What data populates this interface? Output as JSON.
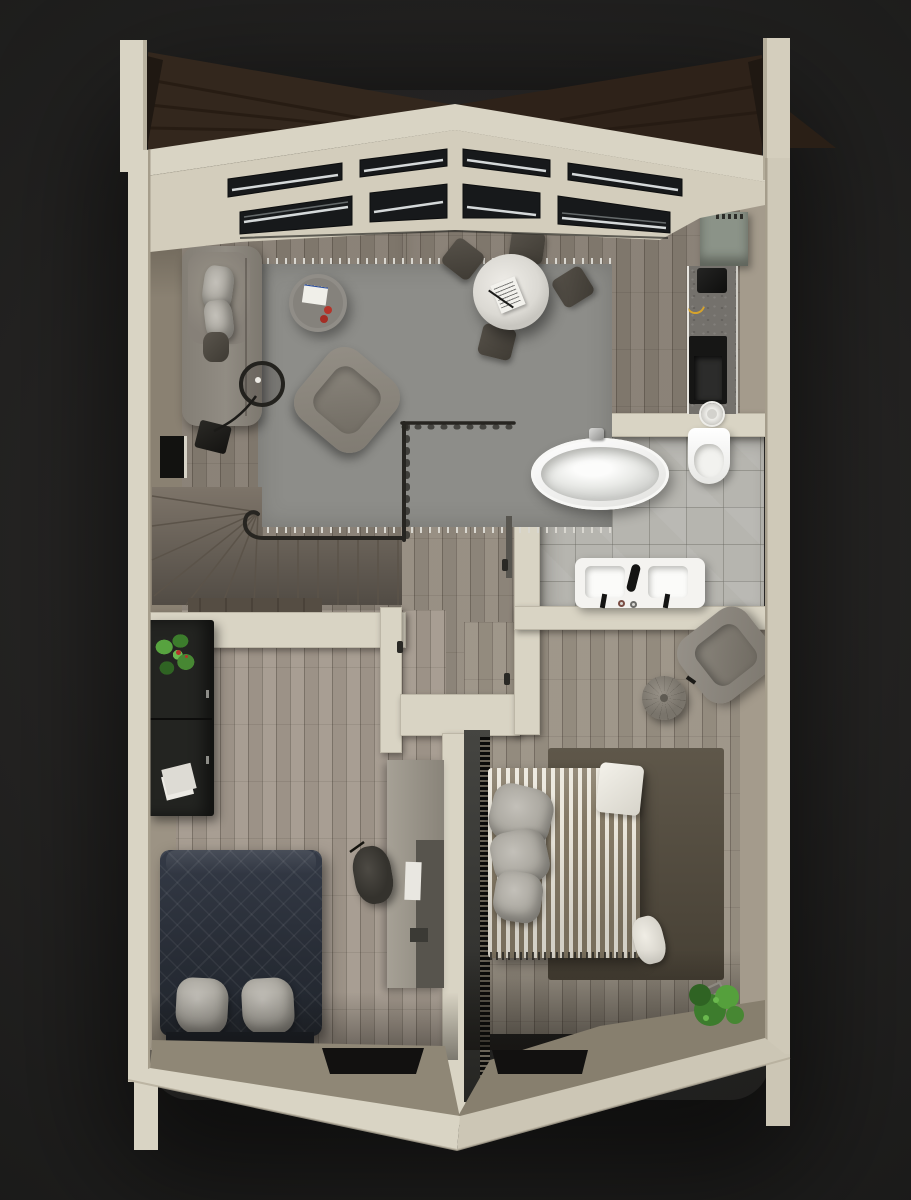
{
  "scene": {
    "type": "3d-floor-plan-top-view",
    "style": "photoreal architectural render, single storey, gabled shell",
    "background": "#242322"
  },
  "palette": {
    "background": "#242322",
    "wall": "#d9d4c4",
    "wall_shade": "#ccc6b5",
    "wall_inner_left": "#8a8172",
    "wall_inner_light": "#9c9384",
    "wall_inner_right": "#a49b8c",
    "tan_face": "#8f8776",
    "roof_wood": "#33271d",
    "skylight_glass": "#17191b",
    "skylight_glint": "#e6eaeb",
    "floor_living": "#867d72",
    "floor_hall": "#948b7f",
    "floor_bedroom_small": "#a49a8e",
    "floor_bedroom_master": "#9b9285",
    "floor_stairs": "#7d7469",
    "tile_bathroom": "#b6b5af",
    "rug_gray": "#8d8d89",
    "rug_olive": "#564e40",
    "sofa": "#868078",
    "armchair": "#8c877e",
    "chair_dark": "#4b463f",
    "dining_table": "#e7e5e0",
    "coffee_table": "#85827c",
    "counter_concrete": "#74716c",
    "cabinet_sage": "#8b9388",
    "appliance_black": "#161615",
    "porcelain": "#f4f3f0",
    "bed_dark_duvet": "#2b303a",
    "bed_base_dark": "#1b1f26",
    "pillow_light": "#b3b0a9",
    "stripe_light": "#ebe7dc",
    "stripe_dark": "#857a66",
    "radiator_black": "#0b0b0a",
    "sideboard_black": "#232421",
    "desk": "#9c968a",
    "wardrobe": "#57544d",
    "plant_green": "#4a8f38",
    "accent_red": "#b5342a",
    "banana_yellow": "#d6a32c",
    "handrail": "#272521",
    "window_slot": "#121110"
  },
  "rooms": {
    "living_dining": {
      "name": "living-dining-room",
      "furniture": [
        "sofa",
        "sofa-pillows",
        "floor-lamp",
        "area-rug-fringed",
        "round-coffee-table",
        "book",
        "red-cups",
        "lounge-armchair",
        "round-dining-table",
        "menu-paper",
        "dining-chair-x4",
        "skylight-roof-windows"
      ]
    },
    "kitchen": {
      "name": "kitchen-strip",
      "furniture": [
        "sage-cabinet",
        "concrete-counter",
        "coffee-machine",
        "banana",
        "black-cooktop",
        "round-sink"
      ]
    },
    "bathroom": {
      "name": "bathroom",
      "furniture": [
        "oval-bathtub",
        "tub-faucet",
        "wall-hung-toilet",
        "double-sink-vanity",
        "black-faucets"
      ]
    },
    "landing": {
      "name": "stair-landing-hall",
      "furniture": [
        "winder-staircase",
        "curved-handrail",
        "glass-partition",
        "doors-with-handles"
      ]
    },
    "bedroom_small": {
      "name": "bedroom-left",
      "furniture": [
        "black-sideboard",
        "potted-plant",
        "papers",
        "dark-quilted-double-bed",
        "two-light-pillows",
        "desk",
        "wardrobe-panel",
        "stool",
        "floor-window-slot"
      ]
    },
    "bedroom_master": {
      "name": "bedroom-right",
      "furniture": [
        "wall-radiator",
        "striped-double-bed",
        "gray-pillow-stack",
        "white-pillow",
        "olive-rug",
        "lounge-chair",
        "round-pouf",
        "toppled-potted-plant",
        "floor-window-slot"
      ]
    }
  }
}
